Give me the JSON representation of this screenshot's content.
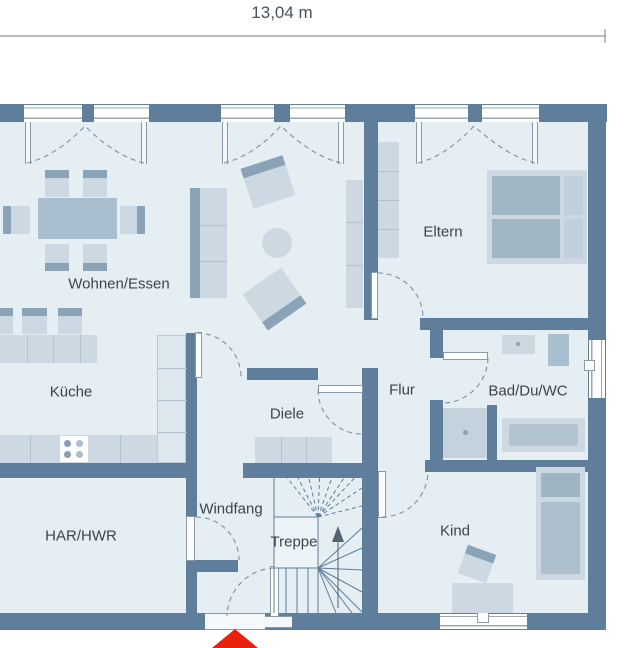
{
  "dimension": {
    "label": "13,04 m"
  },
  "rooms": {
    "wohnen_essen": "Wohnen/Essen",
    "kueche": "Küche",
    "diele": "Diele",
    "flur": "Flur",
    "eltern": "Eltern",
    "bad": "Bad/Du/WC",
    "kind": "Kind",
    "windfang": "Windfang",
    "treppe": "Treppe",
    "har_hwr": "HAR/HWR"
  },
  "colors": {
    "wall": "#5e7e9b",
    "floor": "#e4eef3",
    "furniture_light": "#ccd8e2",
    "furniture_medium": "#a9bece",
    "furniture_dark": "#8aa3b7",
    "entrance_arrow_red": "#e8220c",
    "label_text": "#3c444c"
  },
  "markers": {
    "entrance_arrow": "entrance-direction-triangle"
  }
}
